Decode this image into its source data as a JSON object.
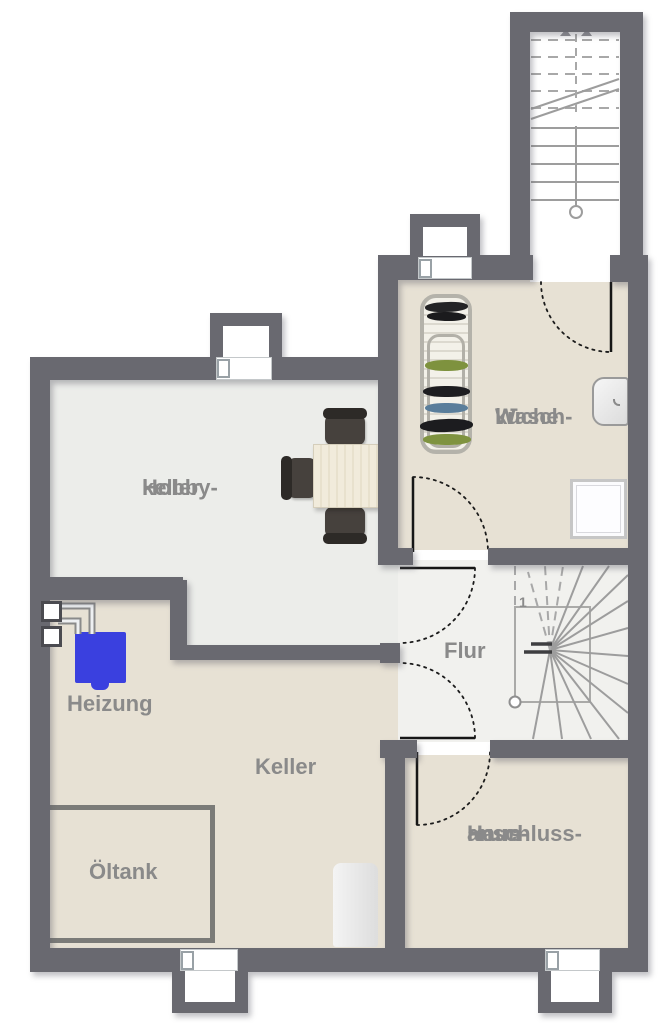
{
  "plan": {
    "rooms": {
      "hobbykeller": {
        "line1": "Hobby-",
        "line2": "keller"
      },
      "waschkueche": {
        "line1": "Wasch-",
        "line2": "küche"
      },
      "flur": {
        "label": "Flur"
      },
      "heizung": {
        "label": "Heizung"
      },
      "keller": {
        "label": "Keller"
      },
      "oeltank": {
        "label": "Öltank"
      },
      "hausanschlussraum": {
        "line1": "Haus-",
        "line2": "anschluss-",
        "line3": "raum"
      }
    },
    "stairs": {
      "winder_step_number": "1"
    },
    "colors": {
      "wall": "#696970",
      "floor_light": "#ecedea",
      "floor_flur": "#f1f1ee",
      "floor_beige": "#e7e1d4",
      "label_text": "#8a8a8a",
      "boiler_blue": "#3a40df",
      "window_glass": "#e4f0f5"
    }
  }
}
